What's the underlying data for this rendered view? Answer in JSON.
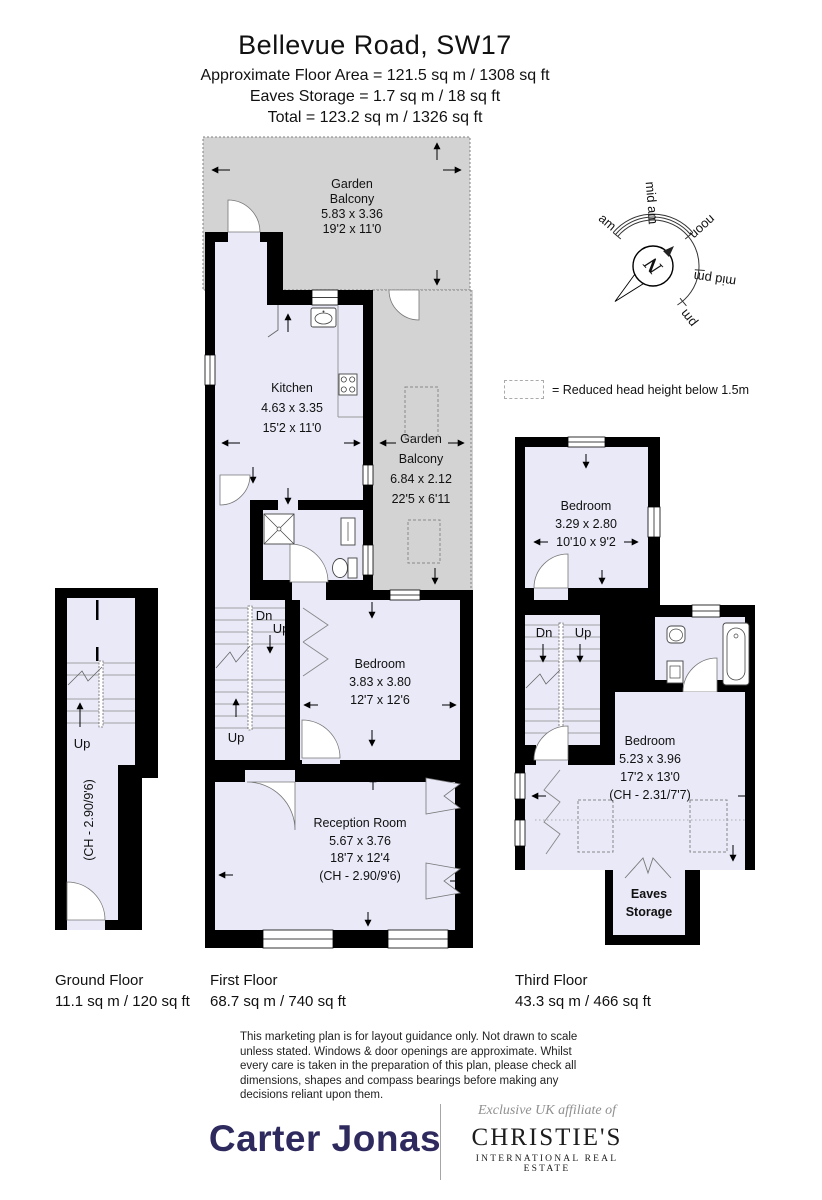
{
  "colors": {
    "room": "#e9e9f8",
    "balcony": "#d3d3d3",
    "wall": "#000000",
    "carter_navy": "#2e2a5e",
    "dashed_outline": "#888888"
  },
  "header": {
    "title": "Bellevue Road, SW17",
    "area_line": "Approximate Floor Area = 121.5 sq m / 1308 sq ft",
    "eaves_line": "Eaves Storage = 1.7 sq m / 18 sq ft",
    "total_line": "Total = 123.2 sq m / 1326 sq ft"
  },
  "compass": {
    "labels": [
      "am",
      "mid am",
      "noon",
      "mid pm",
      "pm"
    ],
    "north": "N"
  },
  "legend": {
    "text": "= Reduced head height below 1.5m"
  },
  "ground_floor": {
    "name": "Ground Floor",
    "area": "11.1 sq m / 120 sq ft",
    "up": "Up",
    "ch": "(CH - 2.90/9'6)"
  },
  "first_floor": {
    "name": "First Floor",
    "area": "68.7 sq m / 740 sq ft",
    "garden_balcony_top": [
      "Garden",
      "Balcony",
      "5.83 x 3.36",
      "19'2 x 11'0"
    ],
    "garden_balcony_side": [
      "Garden",
      "Balcony",
      "6.84 x 2.12",
      "22'5 x 6'11"
    ],
    "kitchen": [
      "Kitchen",
      "4.63 x 3.35",
      "15'2 x 11'0"
    ],
    "bedroom": [
      "Bedroom",
      "3.83 x 3.80",
      "12'7 x 12'6"
    ],
    "reception": [
      "Reception Room",
      "5.67 x 3.76",
      "18'7 x 12'4",
      "(CH - 2.90/9'6)"
    ],
    "dn": "Dn",
    "up": "Up",
    "up2": "Up"
  },
  "third_floor": {
    "name": "Third Floor",
    "area": "43.3 sq m / 466 sq ft",
    "bedroom_small": [
      "Bedroom",
      "3.29 x 2.80",
      "10'10 x 9'2"
    ],
    "bedroom_main": [
      "Bedroom",
      "5.23 x 3.96",
      "17'2 x 13'0",
      "(CH - 2.31/7'7)"
    ],
    "eaves": [
      "Eaves",
      "Storage"
    ],
    "dn": "Dn",
    "up": "Up"
  },
  "disclaimer": "This marketing plan is for layout guidance only. Not drawn to scale unless stated. Windows & door openings are approximate. Whilst every care is taken in the preparation of this plan, please check all dimensions, shapes and compass bearings before making any decisions reliant upon them.",
  "footer": {
    "carter_jonas": "Carter Jonas",
    "affiliate": "Exclusive UK affiliate of",
    "christies": "CHRISTIE'S",
    "christies_sub": "INTERNATIONAL REAL ESTATE"
  }
}
